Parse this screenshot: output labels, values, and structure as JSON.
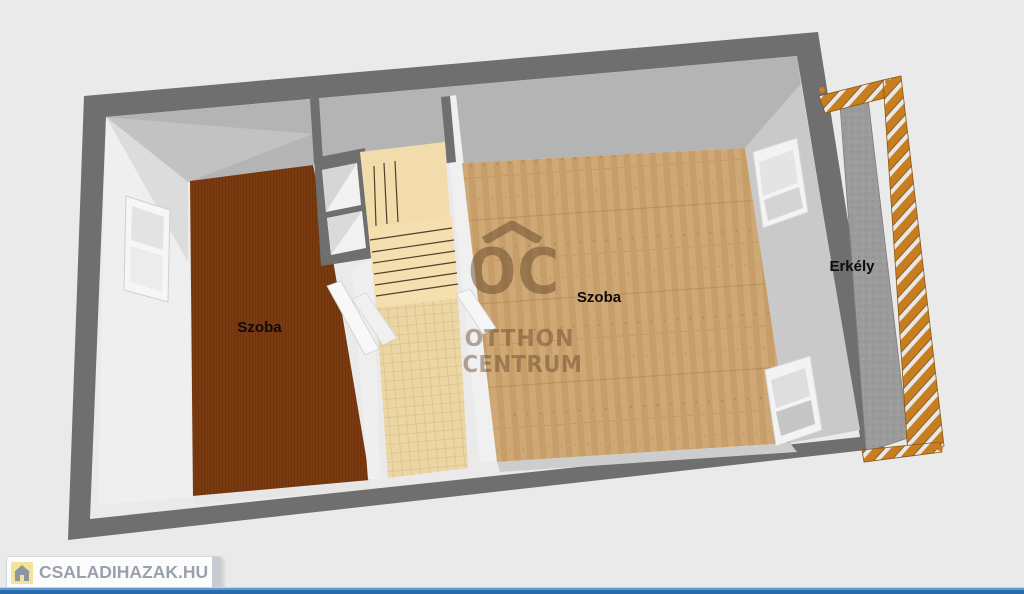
{
  "scene": {
    "type": "3d-floor-plan-render",
    "labels": {
      "room_left": "Szoba",
      "room_right": "Szoba",
      "balcony": "Erkély"
    },
    "watermark": {
      "initials": "OC",
      "line1": "OTTHON",
      "line2": "CENTRUM"
    },
    "branding": {
      "site": "CSALADIHAZAK.HU",
      "icon": "house-icon"
    },
    "colors": {
      "background": "#eaeaea",
      "outer_wall": "#6f6f6f",
      "ceiling": "#b4b4b4",
      "ceiling_shade": "#c2c2c2",
      "wall_face": "#efefef",
      "wall_face_shaded": "#c9c9c9",
      "room_left_floor": "#7a3a11",
      "room_right_floor": "#cba571",
      "corridor_floor": "#ecd6a4",
      "stairs_floor": "#f3dcab",
      "balcony_floor": "#9b9b9b",
      "railing_wood": "#c67e20",
      "accent_bar_light": "#5e9bd1",
      "accent_bar_dark": "#2a6cab",
      "label_text": "#0c0c0c",
      "logo_text": "#9aa1aa",
      "logo_icon_bg": "#f1e39a"
    }
  }
}
